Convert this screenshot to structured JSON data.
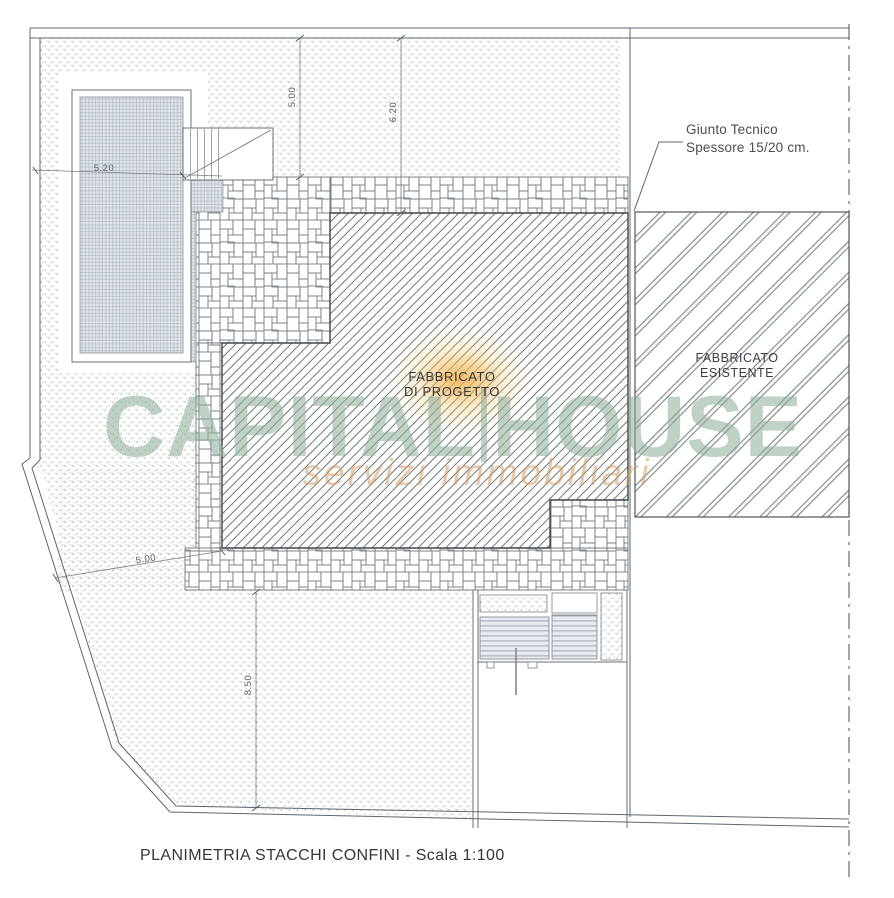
{
  "caption": "PLANIMETRIA STACCHI CONFINI - Scala 1:100",
  "labels": {
    "new_building_line1": "FABBRICATO",
    "new_building_line2": "DI PROGETTO",
    "existing_building_line1": "FABBRICATO",
    "existing_building_line2": "ESISTENTE",
    "joint_note_line1": "Giunto Tecnico",
    "joint_note_line2": "Spessore 15/20 cm."
  },
  "dimensions": {
    "pool_width": "5.20",
    "top_setback_left": "5.00",
    "top_setback_right": "6.20",
    "side_setback_left": "5.00",
    "bottom_setback": "8.50"
  },
  "watermark": {
    "brand_part1": "CAPITAL",
    "brand_part2": "HOUSE",
    "tagline": "servizi immobiliari"
  },
  "colors": {
    "watermark_green": "#92AF9B",
    "tagline_orange": "#D79A62",
    "logo_orange": "#F6C35F",
    "drawing_line_gray": "#5F666E",
    "hatch_line_gray": "#6E7880",
    "paper_white": "#FFFFFF"
  }
}
